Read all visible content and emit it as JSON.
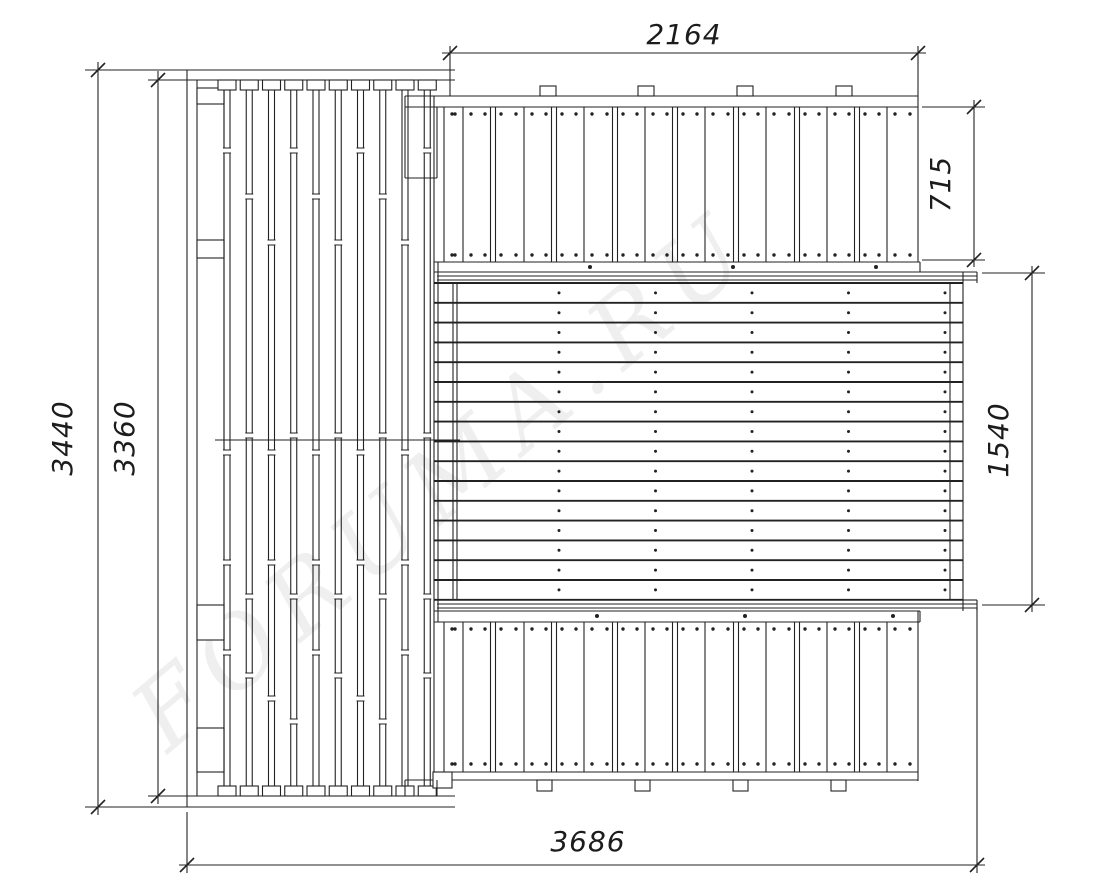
{
  "drawing": {
    "description": "top-view construction plan of a wooden deck frame with plank decking",
    "line_color": "#222222",
    "background_color": "#ffffff"
  },
  "dimensions": {
    "top_width": "2164",
    "right_top_depth": "715",
    "right_middle_depth": "1540",
    "left_outer_height": "3440",
    "left_inner_height": "3360",
    "bottom_total_width": "3686"
  },
  "watermark": {
    "text": "FORUMA.RU"
  },
  "structure": {
    "left_frame": {
      "joist_count": 10,
      "blocking_count": 4
    },
    "top_deck": {
      "plank_count": 16,
      "mount_tab_count": 4,
      "screw_rows": 2
    },
    "middle_deck": {
      "board_count": 16,
      "screw_column_count": 5,
      "ledger_screws": 3
    },
    "bottom_deck": {
      "plank_count": 16,
      "mount_tab_count": 4,
      "screw_rows": 2
    }
  }
}
